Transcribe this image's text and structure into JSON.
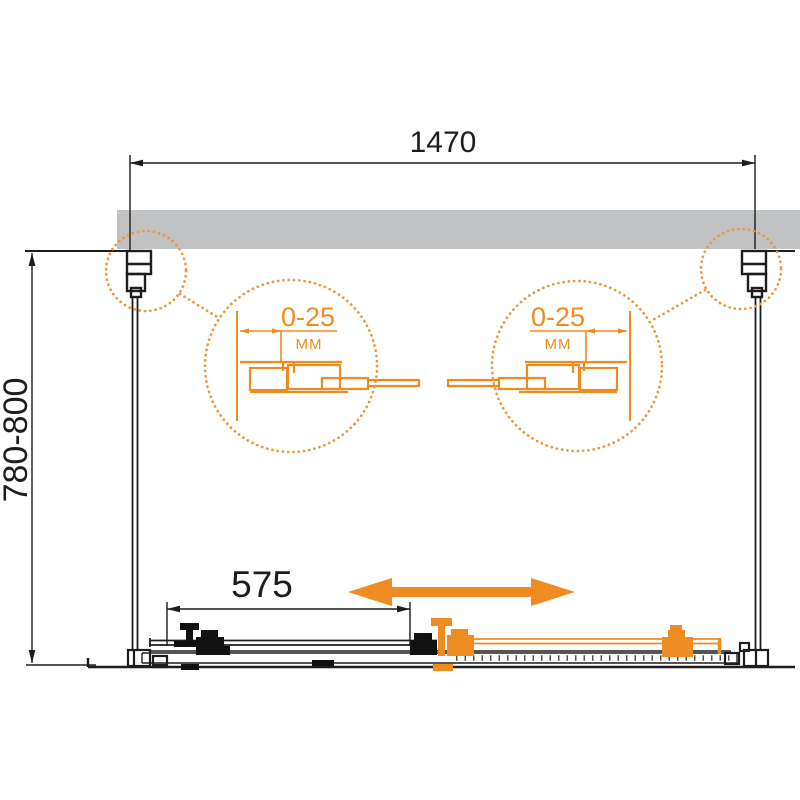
{
  "diagram": {
    "overall_width": {
      "label": "1470"
    },
    "overall_depth": {
      "label": "780-800"
    },
    "door_width": {
      "label": "575"
    },
    "details": {
      "left": {
        "value": "0-25",
        "unit": "MM"
      },
      "right": {
        "value": "0-25",
        "unit": "MM"
      }
    },
    "colors": {
      "accent_orange": "#ee8b21",
      "dotted_orange": "#f0953a",
      "wall_gray": "#c0c2c4",
      "line_black": "#1d1d1d"
    }
  }
}
